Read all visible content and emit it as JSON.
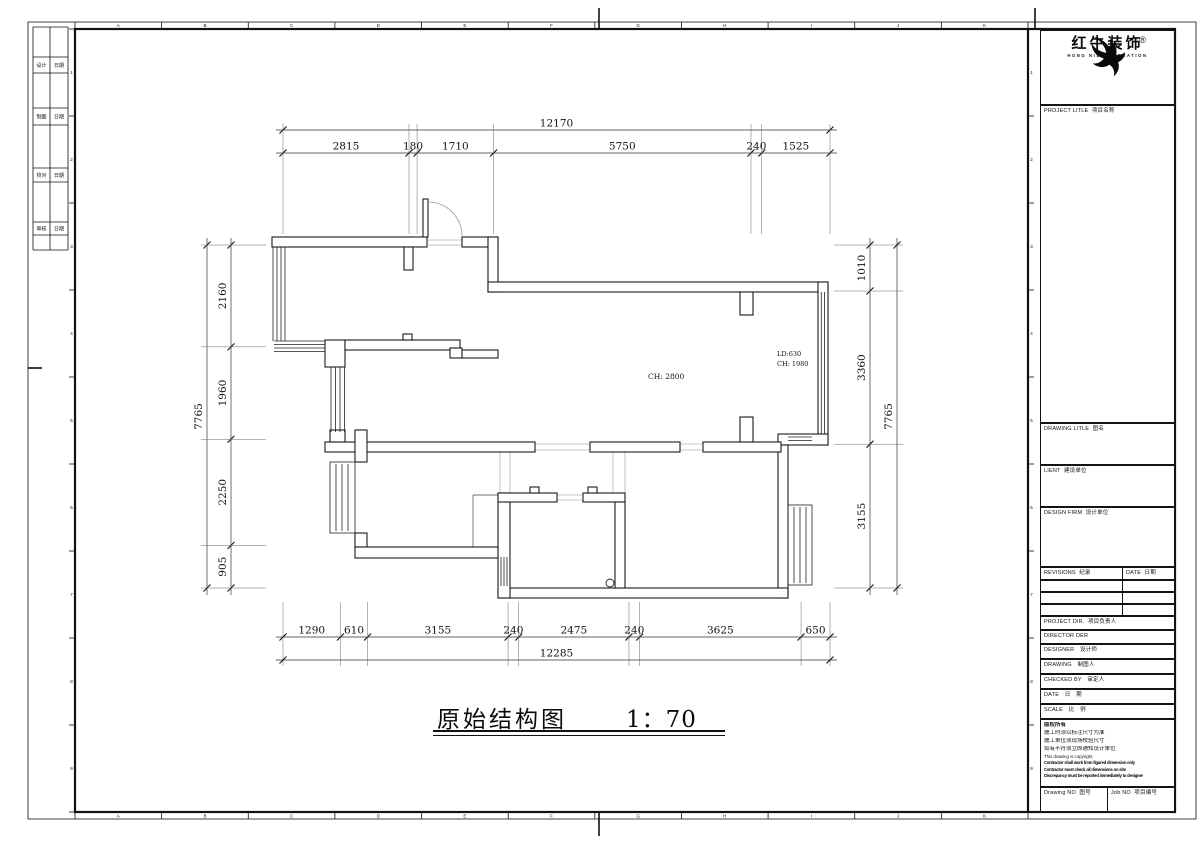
{
  "drawing": {
    "title": "原始结构图",
    "scale": "1：70",
    "annotations": {
      "ch_room": "CH: 2800",
      "ld_door": "LD:630",
      "ch_door": "CH: 1980"
    }
  },
  "dimensions": {
    "top_overall": [
      12170
    ],
    "top_segments": [
      2815,
      180,
      1710,
      5750,
      240,
      1525
    ],
    "bottom_segments": [
      1290,
      610,
      3155,
      240,
      2475,
      240,
      3625,
      650
    ],
    "bottom_overall": [
      12285
    ],
    "left_overall": [
      7765
    ],
    "left_segments": [
      2160,
      1960,
      2250,
      905
    ],
    "right_overall": [
      7765
    ],
    "right_segments": [
      1010,
      3360,
      3155
    ]
  },
  "border": {
    "column_letters": [
      "A",
      "B",
      "C",
      "D",
      "E",
      "F",
      "G",
      "H",
      "I",
      "J",
      "K"
    ],
    "row_numbers": [
      "1",
      "2",
      "3",
      "4",
      "5",
      "6",
      "7",
      "8",
      "9"
    ]
  },
  "signoff_rows": [
    {
      "left": "设计",
      "right": "日期"
    },
    {
      "left": "制图",
      "right": "日期"
    },
    {
      "left": "校对",
      "right": "日期"
    },
    {
      "left": "审核",
      "right": "日期"
    }
  ],
  "titleblock": {
    "brand": "红牛装饰",
    "brand_en": "HONG NIU DECORATION",
    "registered": "®",
    "project_title": "PROJECT LITLE  项目名称",
    "drawing_title": "DRAWING LITLE  图名",
    "client": "LIENT  建设单位",
    "design_firm": "DESIGN FIRM  设计单位",
    "revisions": "REVISIONS  纪录",
    "rev_date": "DATE  日期",
    "project_dir": "PROJECT DIR.  项目负责人",
    "director": "DIRECTOR DER",
    "designer": "DESIGNER　设计师",
    "drawing_by": "DRAWING　制图人",
    "checked_by": "CHECKED BY　审定人",
    "date": "DATE　日　期",
    "scale_label": "SCALE　比　例",
    "copyright_lines": [
      "版权所有",
      "施工时须以标注尺寸为准",
      "施工单位须现场校验尺寸",
      "如有不符须立即通知设计单位",
      "This drawing is copyright",
      "Contractor shall work from figured dimension only",
      "Contractor must check all dimensions on site",
      "Discrepancy must be reported immediately to designer"
    ],
    "drawing_no": "Drawing NO  图号",
    "job_no": "Job NO  项目编号"
  }
}
